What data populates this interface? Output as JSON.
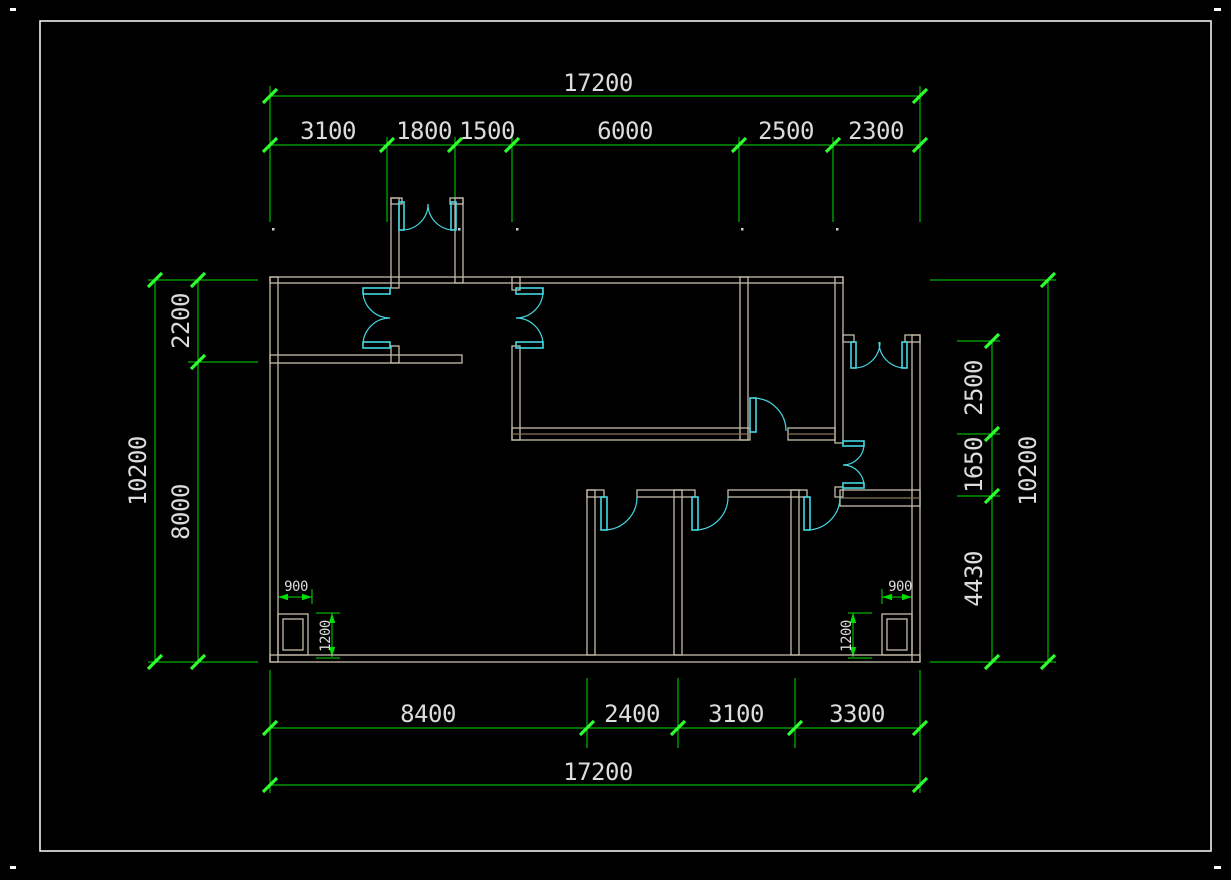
{
  "app": {
    "type": "cad-floor-plan",
    "background": "#000000",
    "frame_color": "#ffffff",
    "wall_color": "#c6bcab",
    "wall_inner_color": "#8a7458",
    "door_color": "#45d7e2",
    "dim_color": "#00dd00",
    "tick_color": "#2eff2e",
    "text_color": "#dcdcdc"
  },
  "dimensions": {
    "top": {
      "total": "17200",
      "segments": [
        "3100",
        "1800",
        "1500",
        "6000",
        "2500",
        "2300"
      ]
    },
    "bottom": {
      "total": "17200",
      "segments": [
        "8400",
        "2400",
        "3100",
        "3300"
      ]
    },
    "left": {
      "total": "10200",
      "segments": [
        "2200",
        "8000"
      ]
    },
    "right": {
      "total": "10200",
      "segments": [
        "2500",
        "1650",
        "4430"
      ]
    },
    "corner_details": {
      "left": [
        "900",
        "1200"
      ],
      "right": [
        "900",
        "1200"
      ]
    }
  },
  "drawing": {
    "frame": [
      40,
      21,
      1171,
      830
    ],
    "corner_marks": [
      [
        10,
        8,
        6,
        3
      ],
      [
        1214,
        8,
        7,
        3
      ],
      [
        10,
        866,
        6,
        3
      ],
      [
        1214,
        866,
        7,
        3
      ]
    ],
    "walls": [
      [
        270,
        277,
        8,
        385
      ],
      [
        270,
        277,
        573,
        6
      ],
      [
        835,
        277,
        8,
        166
      ],
      [
        843,
        335,
        11,
        7
      ],
      [
        905,
        335,
        15,
        7
      ],
      [
        912,
        335,
        8,
        327
      ],
      [
        270,
        655,
        650,
        7
      ],
      [
        391,
        198,
        8,
        90
      ],
      [
        391,
        346,
        8,
        17
      ],
      [
        455,
        198,
        8,
        85
      ],
      [
        391,
        198,
        11,
        6
      ],
      [
        450,
        198,
        13,
        6
      ],
      [
        270,
        355,
        192,
        8
      ],
      [
        512,
        277,
        8,
        13
      ],
      [
        512,
        346,
        8,
        94
      ],
      [
        740,
        277,
        8,
        163
      ],
      [
        512,
        428,
        238,
        12
      ],
      [
        788,
        428,
        47,
        12
      ],
      [
        835,
        487,
        8,
        10
      ],
      [
        587,
        490,
        17,
        7
      ],
      [
        637,
        490,
        58,
        7
      ],
      [
        728,
        490,
        79,
        7
      ],
      [
        840,
        490,
        80,
        16
      ],
      [
        587,
        490,
        8,
        165
      ],
      [
        674,
        490,
        8,
        165
      ],
      [
        791,
        490,
        8,
        165
      ],
      [
        278,
        614,
        30,
        41
      ],
      [
        283,
        619,
        20,
        31
      ],
      [
        882,
        614,
        30,
        41
      ],
      [
        887,
        619,
        20,
        31
      ]
    ],
    "wall_midlines": [
      [
        512,
        434,
        750,
        434
      ],
      [
        788,
        434,
        835,
        434
      ],
      [
        840,
        498,
        920,
        498
      ]
    ],
    "door_leaves": [
      [
        363,
        288,
        27,
        6
      ],
      [
        363,
        342,
        27,
        6
      ],
      [
        516,
        288,
        27,
        6
      ],
      [
        516,
        342,
        27,
        6
      ],
      [
        843,
        441,
        21,
        5
      ],
      [
        843,
        483,
        21,
        5
      ],
      [
        399,
        202,
        5,
        28
      ],
      [
        451,
        202,
        5,
        28
      ],
      [
        851,
        342,
        5,
        26
      ],
      [
        902,
        342,
        5,
        26
      ],
      [
        750,
        398,
        6,
        34
      ],
      [
        601,
        497,
        6,
        33
      ],
      [
        692,
        497,
        6,
        33
      ],
      [
        804,
        497,
        6,
        33
      ]
    ],
    "door_arcs": [
      "M363,291 A27,27 0 0 0 390,318",
      "M363,345 A27,27 0 0 1 390,318",
      "M543,291 A27,27 0 0 1 516,318",
      "M543,345 A27,27 0 0 0 516,318",
      "M864,444 A21,21 0 0 1 843,465",
      "M864,486 A21,21 0 0 0 843,465",
      "M402,230 A26,26 0 0 0 428,204",
      "M454,230 A26,26 0 0 1 428,204",
      "M854,368 A26,26 0 0 0 880,342",
      "M905,368 A26,26 0 0 1 879,342",
      "M753,398 A33,33 0 0 1 786,431",
      "M604,530 A33,33 0 0 0 637,497",
      "M695,530 A33,33 0 0 0 728,497",
      "M807,530 A33,33 0 0 0 840,497"
    ],
    "dim_lines": [
      [
        270,
        96,
        920,
        96
      ],
      [
        270,
        145,
        920,
        145
      ],
      [
        270,
        728,
        920,
        728
      ],
      [
        270,
        785,
        920,
        785
      ],
      [
        155,
        280,
        155,
        662
      ],
      [
        198,
        280,
        198,
        662
      ],
      [
        992,
        341,
        992,
        662
      ],
      [
        1048,
        280,
        1048,
        662
      ],
      [
        278,
        597,
        312,
        597
      ],
      [
        332,
        613,
        332,
        657
      ],
      [
        882,
        597,
        912,
        597
      ],
      [
        853,
        613,
        853,
        657
      ]
    ],
    "ext_lines": [
      [
        270,
        86,
        270,
        222
      ],
      [
        387,
        137,
        387,
        222
      ],
      [
        455,
        137,
        455,
        222
      ],
      [
        512,
        137,
        512,
        222
      ],
      [
        739,
        137,
        739,
        222
      ],
      [
        833,
        137,
        833,
        222
      ],
      [
        920,
        86,
        920,
        222
      ],
      [
        270,
        670,
        270,
        793
      ],
      [
        587,
        678,
        587,
        748
      ],
      [
        678,
        678,
        678,
        748
      ],
      [
        795,
        678,
        795,
        748
      ],
      [
        920,
        670,
        920,
        793
      ],
      [
        148,
        280,
        258,
        280
      ],
      [
        188,
        362,
        258,
        362
      ],
      [
        148,
        662,
        258,
        662
      ],
      [
        930,
        280,
        1056,
        280
      ],
      [
        957,
        341,
        1000,
        341
      ],
      [
        957,
        434,
        1000,
        434
      ],
      [
        957,
        496,
        1000,
        496
      ],
      [
        930,
        662,
        1056,
        662
      ],
      [
        312,
        589,
        312,
        604
      ],
      [
        316,
        613,
        340,
        613
      ],
      [
        316,
        658,
        340,
        658
      ],
      [
        882,
        589,
        882,
        604
      ],
      [
        848,
        613,
        872,
        613
      ],
      [
        848,
        658,
        872,
        658
      ]
    ],
    "ticks": [
      [
        270,
        96
      ],
      [
        920,
        96
      ],
      [
        270,
        145
      ],
      [
        387,
        145
      ],
      [
        455,
        145
      ],
      [
        512,
        145
      ],
      [
        739,
        145
      ],
      [
        833,
        145
      ],
      [
        920,
        145
      ],
      [
        270,
        728
      ],
      [
        587,
        728
      ],
      [
        678,
        728
      ],
      [
        795,
        728
      ],
      [
        920,
        728
      ],
      [
        270,
        785
      ],
      [
        920,
        785
      ],
      [
        155,
        280
      ],
      [
        155,
        662
      ],
      [
        198,
        280
      ],
      [
        198,
        362
      ],
      [
        198,
        662
      ],
      [
        992,
        341
      ],
      [
        992,
        434
      ],
      [
        992,
        496
      ],
      [
        992,
        662
      ],
      [
        1048,
        280
      ],
      [
        1048,
        662
      ]
    ],
    "arrows": [
      [
        278,
        597,
        "l"
      ],
      [
        312,
        597,
        "r"
      ],
      [
        332,
        613,
        "u"
      ],
      [
        332,
        657,
        "d"
      ],
      [
        882,
        597,
        "l"
      ],
      [
        912,
        597,
        "r"
      ],
      [
        853,
        613,
        "u"
      ],
      [
        853,
        657,
        "d"
      ]
    ],
    "endpoint_dots": [
      [
        272,
        228
      ],
      [
        458,
        228
      ],
      [
        516,
        228
      ],
      [
        741,
        228
      ],
      [
        836,
        228
      ]
    ],
    "labels": [
      {
        "t": "17200",
        "x": 598,
        "y": 91,
        "s": 24,
        "r": 0
      },
      {
        "t": "3100",
        "x": 328,
        "y": 139,
        "s": 24,
        "r": 0
      },
      {
        "t": "1800",
        "x": 424,
        "y": 139,
        "s": 24,
        "r": 0
      },
      {
        "t": "1500",
        "x": 487,
        "y": 139,
        "s": 24,
        "r": 0
      },
      {
        "t": "6000",
        "x": 625,
        "y": 139,
        "s": 24,
        "r": 0
      },
      {
        "t": "2500",
        "x": 786,
        "y": 139,
        "s": 24,
        "r": 0
      },
      {
        "t": "2300",
        "x": 876,
        "y": 139,
        "s": 24,
        "r": 0
      },
      {
        "t": "8400",
        "x": 428,
        "y": 722,
        "s": 24,
        "r": 0
      },
      {
        "t": "2400",
        "x": 632,
        "y": 722,
        "s": 24,
        "r": 0
      },
      {
        "t": "3100",
        "x": 736,
        "y": 722,
        "s": 24,
        "r": 0
      },
      {
        "t": "3300",
        "x": 857,
        "y": 722,
        "s": 24,
        "r": 0
      },
      {
        "t": "17200",
        "x": 598,
        "y": 780,
        "s": 24,
        "r": 0
      },
      {
        "t": "10200",
        "x": 146,
        "y": 471,
        "s": 24,
        "r": -90
      },
      {
        "t": "2200",
        "x": 189,
        "y": 321,
        "s": 24,
        "r": -90
      },
      {
        "t": "8000",
        "x": 189,
        "y": 512,
        "s": 24,
        "r": -90
      },
      {
        "t": "2500",
        "x": 982,
        "y": 388,
        "s": 24,
        "r": -90
      },
      {
        "t": "1650",
        "x": 982,
        "y": 465,
        "s": 24,
        "r": -90
      },
      {
        "t": "4430",
        "x": 982,
        "y": 579,
        "s": 24,
        "r": -90
      },
      {
        "t": "10200",
        "x": 1036,
        "y": 471,
        "s": 24,
        "r": -90
      },
      {
        "t": "900",
        "x": 296,
        "y": 591,
        "s": 14,
        "r": 0
      },
      {
        "t": "1200",
        "x": 330,
        "y": 636,
        "s": 14,
        "r": -90
      },
      {
        "t": "900",
        "x": 900,
        "y": 591,
        "s": 14,
        "r": 0
      },
      {
        "t": "1200",
        "x": 851,
        "y": 636,
        "s": 14,
        "r": -90
      }
    ]
  }
}
